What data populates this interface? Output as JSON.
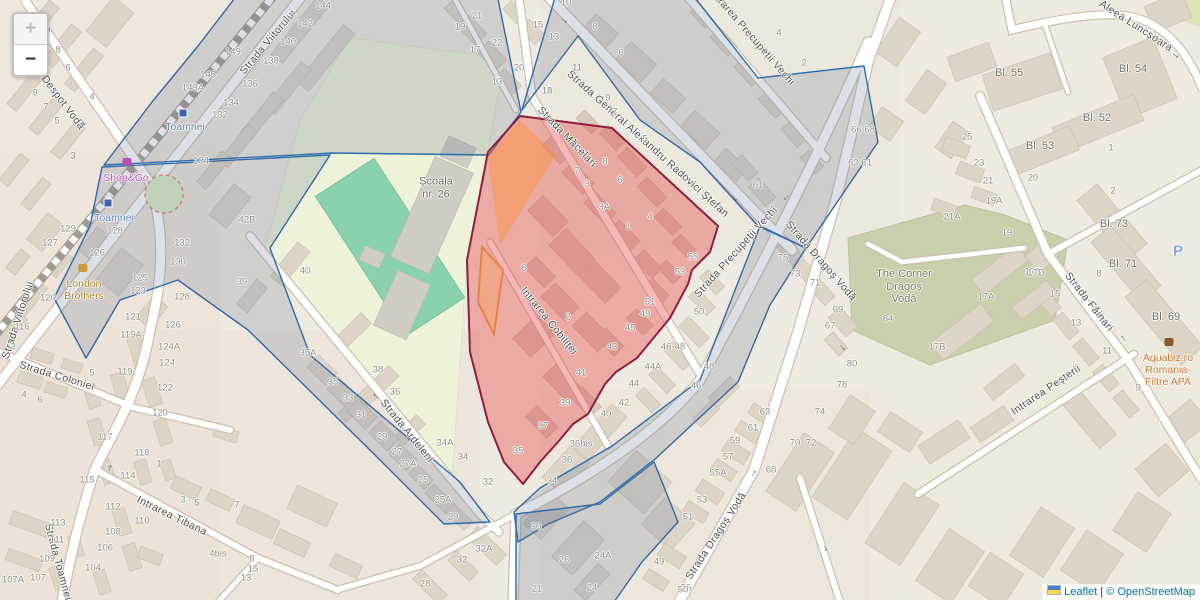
{
  "controls": {
    "zoom_in": "+",
    "zoom_out": "−"
  },
  "attribution": {
    "leaflet_link": "Leaflet",
    "divider": "|",
    "copyright_link": "© OpenStreetMap"
  },
  "overlays": {
    "selection_fill": "rgba(228,80,80,0.42)",
    "selection_stroke": "#8e1e3e",
    "district_fill": "rgba(96,112,140,0.22)",
    "district_stroke": "#2f6ba8",
    "suburb_fill": "rgba(248,148,66,0.5)"
  },
  "street_labels": [
    {
      "t": "Strada Despot Vodă",
      "x": 52,
      "y": 88,
      "r": 53
    },
    {
      "t": "Strada Viitorului",
      "x": 268,
      "y": 42,
      "r": -50
    },
    {
      "t": "Strada Viitorului",
      "x": 18,
      "y": 320,
      "r": -72
    },
    {
      "t": "Strada Coloniei",
      "x": 57,
      "y": 376,
      "r": 17
    },
    {
      "t": "Strada Toamnei",
      "x": 58,
      "y": 562,
      "r": 75
    },
    {
      "t": "Intrarea Tibana",
      "x": 172,
      "y": 516,
      "r": 26
    },
    {
      "t": "Strada Ardeleni",
      "x": 407,
      "y": 431,
      "r": 51
    },
    {
      "t": "Intrarea Cobiliței",
      "x": 549,
      "y": 321,
      "r": 51
    },
    {
      "t": "Strada Măcelari",
      "x": 567,
      "y": 137,
      "r": 46
    },
    {
      "t": "Strada General Alexandru Radovici Ștefan",
      "x": 648,
      "y": 144,
      "r": 42
    },
    {
      "t": "Intrarea Precupeții Vechi",
      "x": 752,
      "y": 37,
      "r": 49
    },
    {
      "t": "Strada Precupeții Vechi",
      "x": 736,
      "y": 252,
      "r": -48
    },
    {
      "t": "Strada Dragoș Vodă",
      "x": 821,
      "y": 261,
      "r": 49
    },
    {
      "t": "Strada Dragoș Vodă",
      "x": 716,
      "y": 536,
      "r": -57
    },
    {
      "t": "Aleea Luncșoara",
      "x": 1136,
      "y": 26,
      "r": 33
    },
    {
      "t": "Strada Făinari",
      "x": 1089,
      "y": 302,
      "r": 52
    },
    {
      "t": "Intrarea Peșterii",
      "x": 1046,
      "y": 390,
      "r": -34
    }
  ],
  "house_numbers": [
    {
      "t": "10",
      "x": 45,
      "y": 30
    },
    {
      "t": "8",
      "x": 58,
      "y": 50
    },
    {
      "t": "6",
      "x": 68,
      "y": 68
    },
    {
      "t": "9",
      "x": 35,
      "y": 93
    },
    {
      "t": "7",
      "x": 46,
      "y": 107
    },
    {
      "t": "5",
      "x": 57,
      "y": 121
    },
    {
      "t": "4",
      "x": 92,
      "y": 97
    },
    {
      "t": "143A",
      "x": 193,
      "y": 88
    },
    {
      "t": "145",
      "x": 208,
      "y": 75
    },
    {
      "t": "149",
      "x": 233,
      "y": 52
    },
    {
      "t": "144",
      "x": 323,
      "y": 6
    },
    {
      "t": "142",
      "x": 305,
      "y": 24
    },
    {
      "t": "140",
      "x": 288,
      "y": 42
    },
    {
      "t": "138",
      "x": 271,
      "y": 61
    },
    {
      "t": "136",
      "x": 250,
      "y": 84
    },
    {
      "t": "134",
      "x": 231,
      "y": 103
    },
    {
      "t": "132",
      "x": 220,
      "y": 115
    },
    {
      "t": "134",
      "x": 201,
      "y": 161
    },
    {
      "t": "3",
      "x": 73,
      "y": 156
    },
    {
      "t": "129",
      "x": 68,
      "y": 229
    },
    {
      "t": "127",
      "x": 50,
      "y": 243
    },
    {
      "t": "128",
      "x": 115,
      "y": 231
    },
    {
      "t": "126",
      "x": 97,
      "y": 253
    },
    {
      "t": "120",
      "x": 48,
      "y": 298
    },
    {
      "t": "116",
      "x": 22,
      "y": 327
    },
    {
      "t": "132",
      "x": 182,
      "y": 243
    },
    {
      "t": "130",
      "x": 178,
      "y": 262
    },
    {
      "t": "128",
      "x": 182,
      "y": 297
    },
    {
      "t": "126",
      "x": 173,
      "y": 325
    },
    {
      "t": "125",
      "x": 140,
      "y": 278
    },
    {
      "t": "123",
      "x": 138,
      "y": 291
    },
    {
      "t": "121",
      "x": 133,
      "y": 317
    },
    {
      "t": "119A",
      "x": 131,
      "y": 335
    },
    {
      "t": "124A",
      "x": 169,
      "y": 347
    },
    {
      "t": "124",
      "x": 167,
      "y": 363
    },
    {
      "t": "122",
      "x": 165,
      "y": 388
    },
    {
      "t": "120",
      "x": 160,
      "y": 413
    },
    {
      "t": "119",
      "x": 125,
      "y": 372
    },
    {
      "t": "5",
      "x": 92,
      "y": 373
    },
    {
      "t": "3",
      "x": 13,
      "y": 347
    },
    {
      "t": "4",
      "x": 24,
      "y": 395
    },
    {
      "t": "6",
      "x": 40,
      "y": 400
    },
    {
      "t": "118",
      "x": 142,
      "y": 453
    },
    {
      "t": "1",
      "x": 159,
      "y": 464
    },
    {
      "t": "117",
      "x": 105,
      "y": 437
    },
    {
      "t": "115",
      "x": 87,
      "y": 480
    },
    {
      "t": "114",
      "x": 128,
      "y": 476
    },
    {
      "t": "113",
      "x": 58,
      "y": 523
    },
    {
      "t": "111",
      "x": 57,
      "y": 540
    },
    {
      "t": "112",
      "x": 113,
      "y": 507
    },
    {
      "t": "110",
      "x": 142,
      "y": 521
    },
    {
      "t": "108",
      "x": 113,
      "y": 532
    },
    {
      "t": "106",
      "x": 105,
      "y": 548
    },
    {
      "t": "109",
      "x": 47,
      "y": 559
    },
    {
      "t": "104",
      "x": 93,
      "y": 568
    },
    {
      "t": "107A",
      "x": 13,
      "y": 580
    },
    {
      "t": "107",
      "x": 38,
      "y": 578
    },
    {
      "t": "3",
      "x": 183,
      "y": 500
    },
    {
      "t": "5",
      "x": 197,
      "y": 503
    },
    {
      "t": "7",
      "x": 237,
      "y": 505
    },
    {
      "t": "4bis",
      "x": 218,
      "y": 554
    },
    {
      "t": "8",
      "x": 252,
      "y": 559
    },
    {
      "t": "15",
      "x": 253,
      "y": 569
    },
    {
      "t": "13",
      "x": 246,
      "y": 578
    },
    {
      "t": "42B",
      "x": 247,
      "y": 220
    },
    {
      "t": "40",
      "x": 305,
      "y": 271
    },
    {
      "t": "39",
      "x": 242,
      "y": 282
    },
    {
      "t": "35A",
      "x": 308,
      "y": 353
    },
    {
      "t": "38",
      "x": 378,
      "y": 370
    },
    {
      "t": "36",
      "x": 395,
      "y": 392
    },
    {
      "t": "35",
      "x": 333,
      "y": 382
    },
    {
      "t": "33",
      "x": 348,
      "y": 398
    },
    {
      "t": "31",
      "x": 361,
      "y": 415
    },
    {
      "t": "29",
      "x": 382,
      "y": 437
    },
    {
      "t": "27",
      "x": 397,
      "y": 452
    },
    {
      "t": "27A",
      "x": 408,
      "y": 464
    },
    {
      "t": "25",
      "x": 423,
      "y": 480
    },
    {
      "t": "34A",
      "x": 445,
      "y": 443
    },
    {
      "t": "34",
      "x": 463,
      "y": 457
    },
    {
      "t": "32",
      "x": 488,
      "y": 482
    },
    {
      "t": "25A",
      "x": 443,
      "y": 500
    },
    {
      "t": "29",
      "x": 453,
      "y": 517
    },
    {
      "t": "32A",
      "x": 484,
      "y": 549
    },
    {
      "t": "32",
      "x": 462,
      "y": 560
    },
    {
      "t": "28",
      "x": 425,
      "y": 584
    },
    {
      "t": "21",
      "x": 477,
      "y": 16
    },
    {
      "t": "19",
      "x": 460,
      "y": 27
    },
    {
      "t": "15",
      "x": 538,
      "y": 25
    },
    {
      "t": "22",
      "x": 497,
      "y": 43
    },
    {
      "t": "17",
      "x": 475,
      "y": 50
    },
    {
      "t": "13",
      "x": 497,
      "y": 82
    },
    {
      "t": "20",
      "x": 519,
      "y": 68
    },
    {
      "t": "11",
      "x": 577,
      "y": 68
    },
    {
      "t": "18",
      "x": 547,
      "y": 91
    },
    {
      "t": "10",
      "x": 566,
      "y": 3
    },
    {
      "t": "13",
      "x": 554,
      "y": 37
    },
    {
      "t": "9",
      "x": 608,
      "y": 98
    },
    {
      "t": "7",
      "x": 615,
      "y": 112
    },
    {
      "t": "5",
      "x": 645,
      "y": 139
    },
    {
      "t": "6",
      "x": 621,
      "y": 53
    },
    {
      "t": "8",
      "x": 595,
      "y": 27
    },
    {
      "t": "4",
      "x": 779,
      "y": 33
    },
    {
      "t": "2",
      "x": 804,
      "y": 63
    },
    {
      "t": "8",
      "x": 605,
      "y": 162
    },
    {
      "t": "6",
      "x": 620,
      "y": 180
    },
    {
      "t": "3A",
      "x": 604,
      "y": 207
    },
    {
      "t": "4",
      "x": 650,
      "y": 217
    },
    {
      "t": "1",
      "x": 628,
      "y": 227
    },
    {
      "t": "3",
      "x": 587,
      "y": 184
    },
    {
      "t": "7",
      "x": 577,
      "y": 171
    },
    {
      "t": "6",
      "x": 524,
      "y": 268
    },
    {
      "t": "2",
      "x": 568,
      "y": 317
    },
    {
      "t": "55",
      "x": 693,
      "y": 257
    },
    {
      "t": "53",
      "x": 680,
      "y": 272
    },
    {
      "t": "51",
      "x": 650,
      "y": 302
    },
    {
      "t": "49",
      "x": 645,
      "y": 314
    },
    {
      "t": "45",
      "x": 630,
      "y": 328
    },
    {
      "t": "43",
      "x": 612,
      "y": 347
    },
    {
      "t": "41",
      "x": 581,
      "y": 373
    },
    {
      "t": "39",
      "x": 565,
      "y": 403
    },
    {
      "t": "37",
      "x": 543,
      "y": 426
    },
    {
      "t": "35",
      "x": 518,
      "y": 451
    },
    {
      "t": "50",
      "x": 699,
      "y": 312
    },
    {
      "t": "46-48",
      "x": 673,
      "y": 347
    },
    {
      "t": "44A",
      "x": 653,
      "y": 367
    },
    {
      "t": "44",
      "x": 634,
      "y": 384
    },
    {
      "t": "42",
      "x": 624,
      "y": 403
    },
    {
      "t": "40",
      "x": 606,
      "y": 414
    },
    {
      "t": "48",
      "x": 709,
      "y": 367
    },
    {
      "t": "46",
      "x": 696,
      "y": 386
    },
    {
      "t": "36bis",
      "x": 581,
      "y": 444
    },
    {
      "t": "36",
      "x": 567,
      "y": 460
    },
    {
      "t": "34",
      "x": 552,
      "y": 481
    },
    {
      "t": "30",
      "x": 536,
      "y": 527
    },
    {
      "t": "26",
      "x": 564,
      "y": 560
    },
    {
      "t": "24A",
      "x": 603,
      "y": 556
    },
    {
      "t": "24",
      "x": 592,
      "y": 588
    },
    {
      "t": "21",
      "x": 537,
      "y": 589
    },
    {
      "t": "56",
      "x": 686,
      "y": 588
    },
    {
      "t": "49",
      "x": 659,
      "y": 562
    },
    {
      "t": "51",
      "x": 688,
      "y": 517
    },
    {
      "t": "53",
      "x": 702,
      "y": 500
    },
    {
      "t": "55A",
      "x": 718,
      "y": 473
    },
    {
      "t": "57",
      "x": 728,
      "y": 457
    },
    {
      "t": "59",
      "x": 735,
      "y": 441
    },
    {
      "t": "61",
      "x": 753,
      "y": 428
    },
    {
      "t": "63",
      "x": 765,
      "y": 412
    },
    {
      "t": "68",
      "x": 771,
      "y": 470
    },
    {
      "t": "70",
      "x": 795,
      "y": 443
    },
    {
      "t": "72",
      "x": 811,
      "y": 443
    },
    {
      "t": "74",
      "x": 820,
      "y": 412
    },
    {
      "t": "78",
      "x": 842,
      "y": 385
    },
    {
      "t": "50",
      "x": 683,
      "y": 590
    },
    {
      "t": "61",
      "x": 758,
      "y": 185
    },
    {
      "t": "75",
      "x": 783,
      "y": 258
    },
    {
      "t": "73",
      "x": 795,
      "y": 274
    },
    {
      "t": "71",
      "x": 815,
      "y": 283
    },
    {
      "t": "69",
      "x": 838,
      "y": 310
    },
    {
      "t": "67",
      "x": 830,
      "y": 326
    },
    {
      "t": "66 68",
      "x": 863,
      "y": 130
    },
    {
      "t": "63 61",
      "x": 860,
      "y": 163
    },
    {
      "t": "84",
      "x": 888,
      "y": 319
    },
    {
      "t": "80",
      "x": 852,
      "y": 364
    },
    {
      "t": "17A",
      "x": 986,
      "y": 297
    },
    {
      "t": "17B",
      "x": 937,
      "y": 347
    },
    {
      "t": "19",
      "x": 1007,
      "y": 233
    },
    {
      "t": "17B",
      "x": 1033,
      "y": 272
    },
    {
      "t": "25",
      "x": 967,
      "y": 137
    },
    {
      "t": "23",
      "x": 979,
      "y": 163
    },
    {
      "t": "21",
      "x": 988,
      "y": 181
    },
    {
      "t": "19A",
      "x": 994,
      "y": 201
    },
    {
      "t": "21A",
      "x": 952,
      "y": 217
    },
    {
      "t": "20",
      "x": 1033,
      "y": 178
    },
    {
      "t": "1",
      "x": 1111,
      "y": 148
    },
    {
      "t": "2",
      "x": 1113,
      "y": 191
    },
    {
      "t": "17D",
      "x": 1036,
      "y": 273
    },
    {
      "t": "15",
      "x": 1055,
      "y": 294
    },
    {
      "t": "13",
      "x": 1076,
      "y": 323
    },
    {
      "t": "11",
      "x": 1107,
      "y": 351
    },
    {
      "t": "9",
      "x": 1138,
      "y": 388
    },
    {
      "t": "8",
      "x": 1099,
      "y": 274
    },
    {
      "t": "Bl. 55",
      "x": 1009,
      "y": 73
    },
    {
      "t": "Bl. 54",
      "x": 1133,
      "y": 69
    },
    {
      "t": "Bl. 52",
      "x": 1097,
      "y": 118
    },
    {
      "t": "Bl. 53",
      "x": 1040,
      "y": 146
    },
    {
      "t": "Bl. 73",
      "x": 1114,
      "y": 224
    },
    {
      "t": "Bl. 71",
      "x": 1123,
      "y": 264
    },
    {
      "t": "Bl. 69",
      "x": 1166,
      "y": 317
    }
  ],
  "poi_labels": [
    {
      "name": "school-label",
      "lines": [
        "Școala",
        "nr. 26"
      ],
      "x": 436,
      "y": 188,
      "c": "#6e6657",
      "s": 11
    },
    {
      "name": "the-corner-dragos-voda-label",
      "lines": [
        "The Corner",
        "Dragoș",
        "Vodă"
      ],
      "x": 904,
      "y": 287,
      "c": "#707b54",
      "s": 11
    },
    {
      "name": "shop-and-go-label",
      "lines": [
        "Shop&Go"
      ],
      "x": 126,
      "y": 178,
      "c": "#bb4ebb",
      "s": 10.5
    },
    {
      "name": "toamnei-station-label",
      "lines": [
        "Toamnei"
      ],
      "x": 114,
      "y": 218,
      "c": "#5a7fc0",
      "s": 10.5
    },
    {
      "name": "toamnei-station-label",
      "lines": [
        "Toamnei"
      ],
      "x": 185,
      "y": 127,
      "c": "#5a7fc0",
      "s": 10.5
    },
    {
      "name": "london-brothers-label",
      "lines": [
        "London",
        "Brothers"
      ],
      "x": 84,
      "y": 290,
      "c": "#aa7d28",
      "s": 10.5
    },
    {
      "name": "aquabiz-label",
      "lines": [
        "Aquabiz.ro",
        "Romania-",
        "Filtre APA"
      ],
      "x": 1168,
      "y": 370,
      "c": "#c9752e",
      "s": 10.5
    },
    {
      "name": "parking-label",
      "lines": [
        "P"
      ],
      "x": 1178,
      "y": 251,
      "c": "#86a7de",
      "s": 15
    }
  ],
  "oneway_arrows": [
    {
      "x": 84,
      "y": 122,
      "r": 53
    },
    {
      "x": 565,
      "y": 20,
      "r": 43
    },
    {
      "x": 735,
      "y": 198,
      "r": 43
    },
    {
      "x": 787,
      "y": 198,
      "r": 133
    },
    {
      "x": 629,
      "y": 364,
      "r": 133
    },
    {
      "x": 843,
      "y": 347,
      "r": 49
    },
    {
      "x": 753,
      "y": 473,
      "r": -57
    },
    {
      "x": 826,
      "y": 548,
      "r": 72
    },
    {
      "x": 1176,
      "y": 55,
      "r": 35
    },
    {
      "x": 1123,
      "y": 339,
      "r": 232
    },
    {
      "x": 375,
      "y": 397,
      "r": 231
    },
    {
      "x": 109,
      "y": 468,
      "r": -78
    }
  ],
  "icons": [
    {
      "name": "railway-station-icon",
      "kind": "station",
      "x": 108,
      "y": 203
    },
    {
      "name": "railway-station-icon",
      "kind": "station",
      "x": 183,
      "y": 113
    },
    {
      "name": "convenience-store-icon",
      "kind": "shop",
      "x": 127,
      "y": 162,
      "c": "#b44fb4"
    },
    {
      "name": "clothes-shop-icon",
      "kind": "shop",
      "x": 83,
      "y": 268,
      "c": "#c89b3c"
    },
    {
      "name": "garden-centre-icon",
      "kind": "shop",
      "x": 1169,
      "y": 342,
      "c": "#8a5a2a"
    }
  ]
}
